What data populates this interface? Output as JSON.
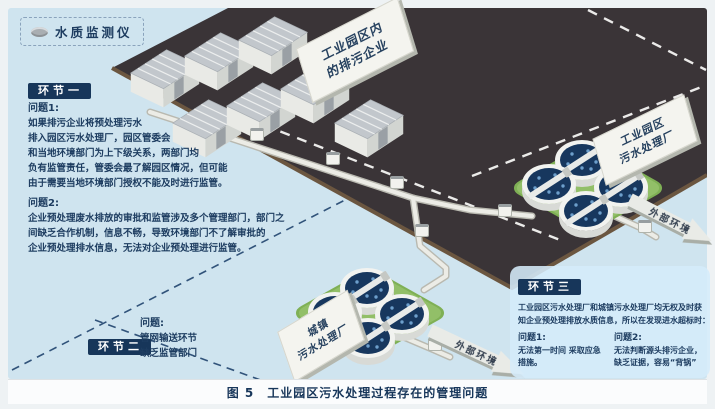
{
  "legend": {
    "label": "水质监测仪"
  },
  "stage1": {
    "badge": "环节一",
    "problem1_title": "问题1:",
    "problem1_lines": [
      "如果排污企业将预处理污水",
      "排入园区污水处理厂，园区管委会",
      "和当地环境部门为上下级关系，两部门均",
      "负有监管责任，管委会最了解园区情况，但可能",
      "由于需要当地环境部门授权不能及时进行监管。"
    ],
    "problem2_title": "问题2:",
    "problem2_lines": [
      "企业预处理废水排放的审批和监管涉及多个管理部门，部门之",
      "间缺乏合作机制，信息不畅，导致环境部门不了解审批的",
      "企业预处理排水信息，无法对企业预处理进行监管。"
    ]
  },
  "stage2": {
    "badge": "环节二",
    "problem_title": "问题:",
    "lines": [
      "管网输送环节",
      "缺乏监管部门"
    ]
  },
  "stage3": {
    "badge": "环节三",
    "intro_lines": [
      "工业园区污水处理厂和城镇污水处理厂均无权及时获",
      "知企业预处理排放水质信息，所以在发现进水超标时："
    ],
    "problem1_title": "问题1:",
    "problem1_lines": [
      "无法第一时间 采取应急",
      "措施。"
    ],
    "problem2_title": "问题2:",
    "problem2_lines": [
      "无法判断源头排污企业，",
      "缺乏证据，容易“背锅”"
    ]
  },
  "signs": {
    "enterprises": {
      "line1": "工业园区内",
      "line2": "的排污企业"
    },
    "industrial_plant": {
      "line1": "工业园区",
      "line2": "污水处理厂"
    },
    "town_plant": {
      "line1": "城镇",
      "line2": "污水处理厂"
    }
  },
  "arrows": {
    "external_env_1": "外部环境",
    "external_env_2": "外部环境"
  },
  "caption": "图 5　工业园区污水处理过程存在的管理问题",
  "colors": {
    "background": "#cfe4ef",
    "ground_dark": "#3a3437",
    "ground_edge": "#6b5640",
    "badge_navy": "#17365a",
    "text_navy": "#1d3c60",
    "pad_green": "#92bf68",
    "tank_navy": "#17375e",
    "pipe": "#e8e8e2"
  }
}
